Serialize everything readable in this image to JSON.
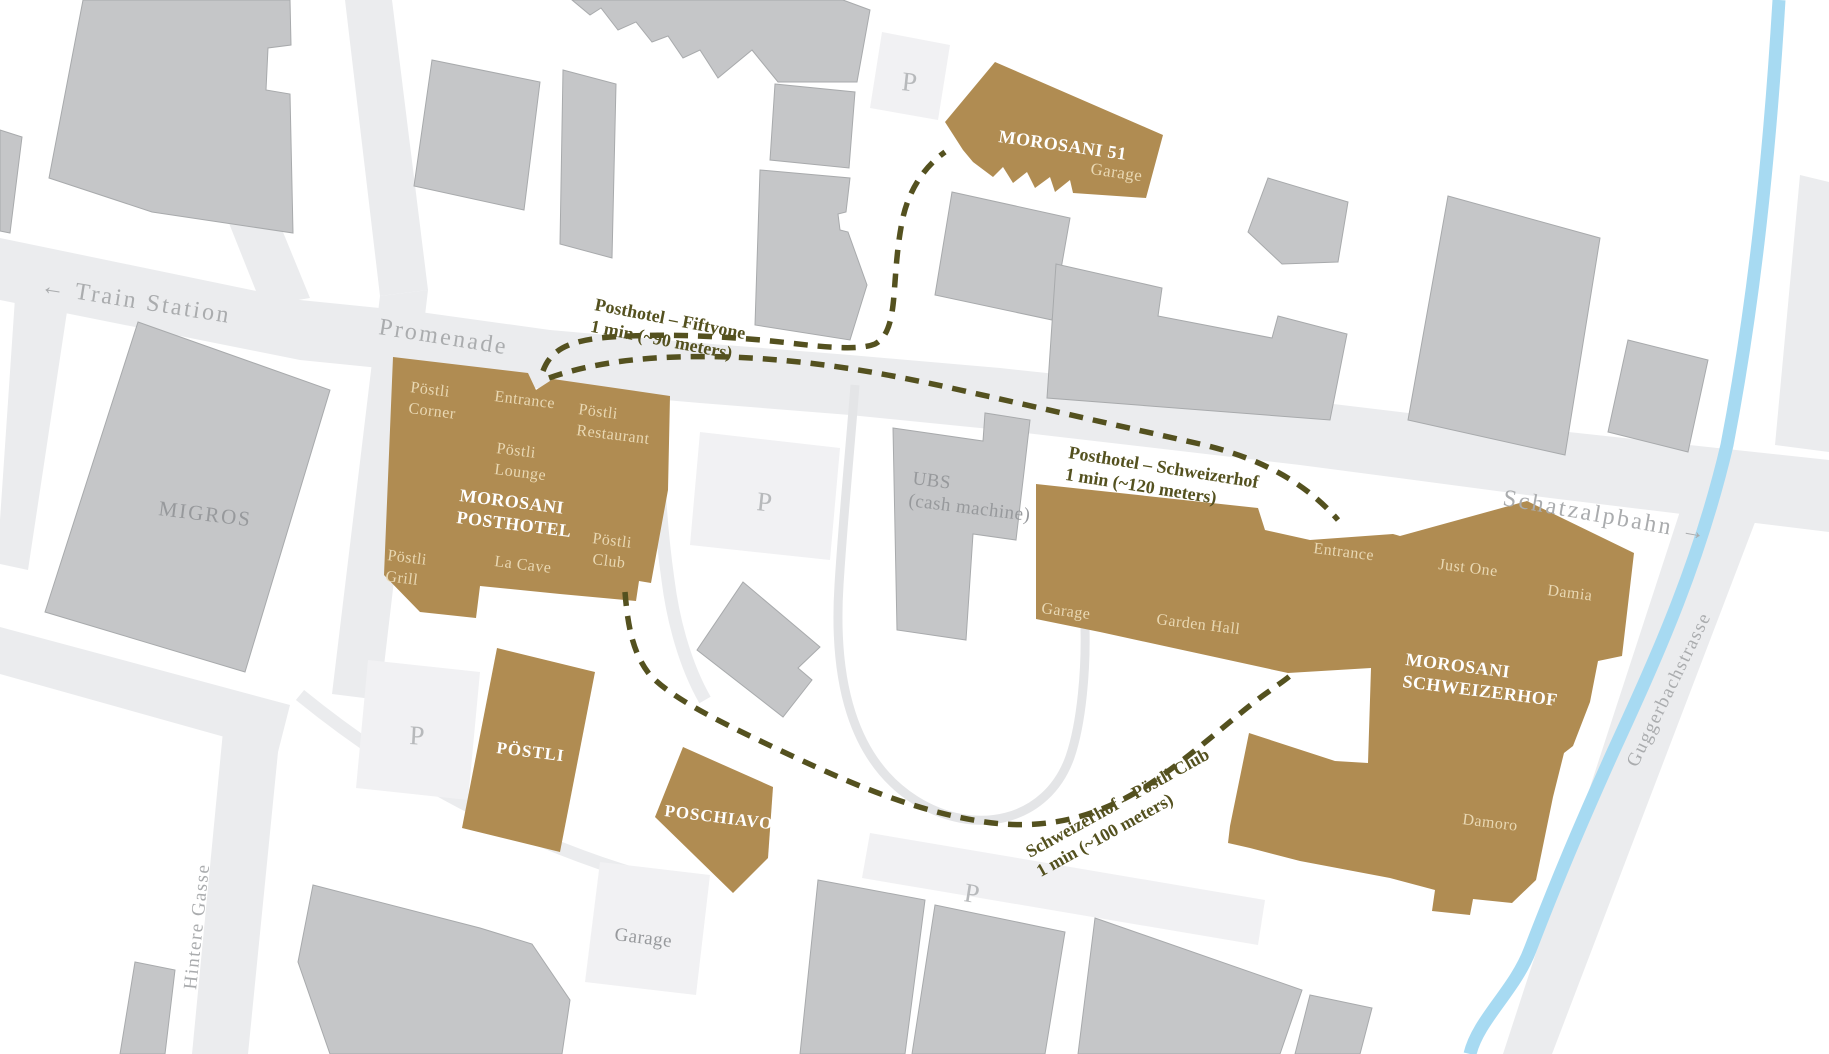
{
  "colors": {
    "gold": "#b08c52",
    "gold_text": "#e9d8b3",
    "building_gray": "#c5c6c8",
    "building_stroke": "#a8aaac",
    "road_gray": "#ebecee",
    "loop_gray": "#e4e5e7",
    "parking_gray": "#f1f1f3",
    "water_blue": "#a7daf2",
    "route_olive": "#54511f",
    "street_text": "#aaacae",
    "map_text_gray": "#97999c",
    "p_letter": "#b7b9bb",
    "white_text": "#ffffff"
  },
  "streets": {
    "train_station": "← Train Station",
    "promenade": "Promenade",
    "schatzalpbahn": "Schatzalpbahn →",
    "guggerbachstrasse": "Guggerbachstrasse",
    "hintere_gasse": "Hintere Gasse"
  },
  "places": {
    "migros": "MIGROS",
    "ubs_line1": "UBS",
    "ubs_line2": "(cash machine)",
    "parking": "P",
    "garage": "Garage"
  },
  "hotels": {
    "morosani51": {
      "name": "MOROSANI 51",
      "garage": "Garage"
    },
    "posthotel": {
      "name_line1": "MOROSANI",
      "name_line2": "POSTHOTEL",
      "postli_corner_line1": "Pöstli",
      "postli_corner_line2": "Corner",
      "entrance": "Entrance",
      "postli_restaurant_line1": "Pöstli",
      "postli_restaurant_line2": "Restaurant",
      "postli_lounge_line1": "Pöstli",
      "postli_lounge_line2": "Lounge",
      "postli_grill_line1": "Pöstli",
      "postli_grill_line2": "Grill",
      "la_cave": "La Cave",
      "postli_club_line1": "Pöstli",
      "postli_club_line2": "Club"
    },
    "postli": {
      "name": "PÖSTLI"
    },
    "poschiavo": {
      "name": "POSCHIAVO"
    },
    "schweizerhof": {
      "name_line1": "MOROSANI",
      "name_line2": "SCHWEIZERHOF",
      "entrance": "Entrance",
      "garage": "Garage",
      "garden_hall": "Garden Hall",
      "just_one": "Just One",
      "damia": "Damia",
      "damoro": "Damoro"
    }
  },
  "routes": {
    "posthotel_fiftyone": {
      "line1": "Posthotel – Fiftyone",
      "line2": "1 min (~90 meters)"
    },
    "posthotel_schweizerhof": {
      "line1": "Posthotel – Schweizerhof",
      "line2": "1 min (~120 meters)"
    },
    "schweizerhof_postli": {
      "line1": "Schweizerhof – Pöstli Club",
      "line2": "1 min (~100 meters)"
    }
  }
}
